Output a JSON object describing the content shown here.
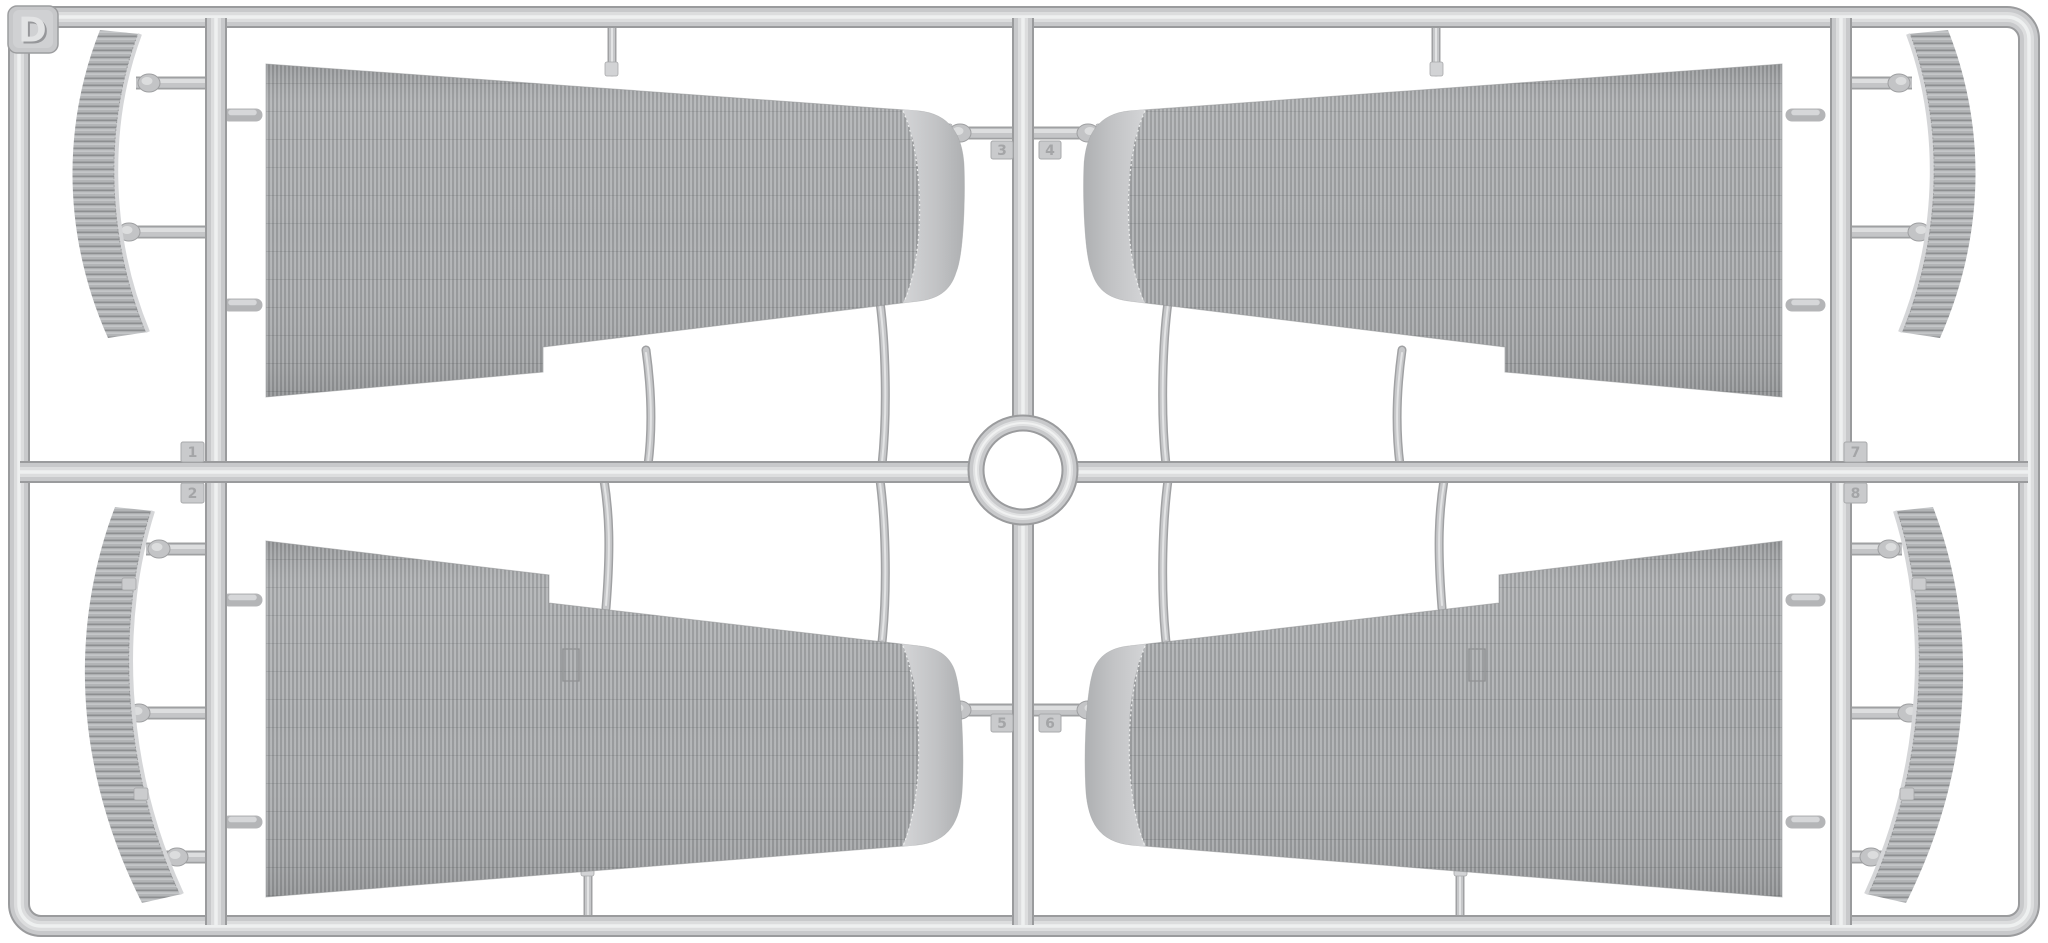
{
  "page": {
    "title": "Injection-molded model kit sprue D with corrugated wing parts",
    "background_color": "#ffffff"
  },
  "sprue": {
    "label": "D",
    "plastic_color": "#c6c7c9",
    "highlight_color": "#eceded",
    "shadow_color": "#919294",
    "corrugation_dark": "#8e9092",
    "corrugation_light": "#bdbfc1",
    "contents": {
      "wing_panels": 4,
      "aileron_strips": 4,
      "center_ring": 1,
      "description": "Four large corrugated tapered wing panels, four narrow curved corrugated strips, cross runners and a central ring"
    },
    "part_tabs": [
      {
        "number": "1",
        "position": "left-junction-top"
      },
      {
        "number": "2",
        "position": "left-junction-bottom"
      },
      {
        "number": "3",
        "position": "center-top-left"
      },
      {
        "number": "4",
        "position": "center-top-right"
      },
      {
        "number": "5",
        "position": "center-bottom-left"
      },
      {
        "number": "6",
        "position": "center-bottom-right"
      },
      {
        "number": "7",
        "position": "right-junction-top"
      },
      {
        "number": "8",
        "position": "right-junction-bottom"
      }
    ]
  }
}
